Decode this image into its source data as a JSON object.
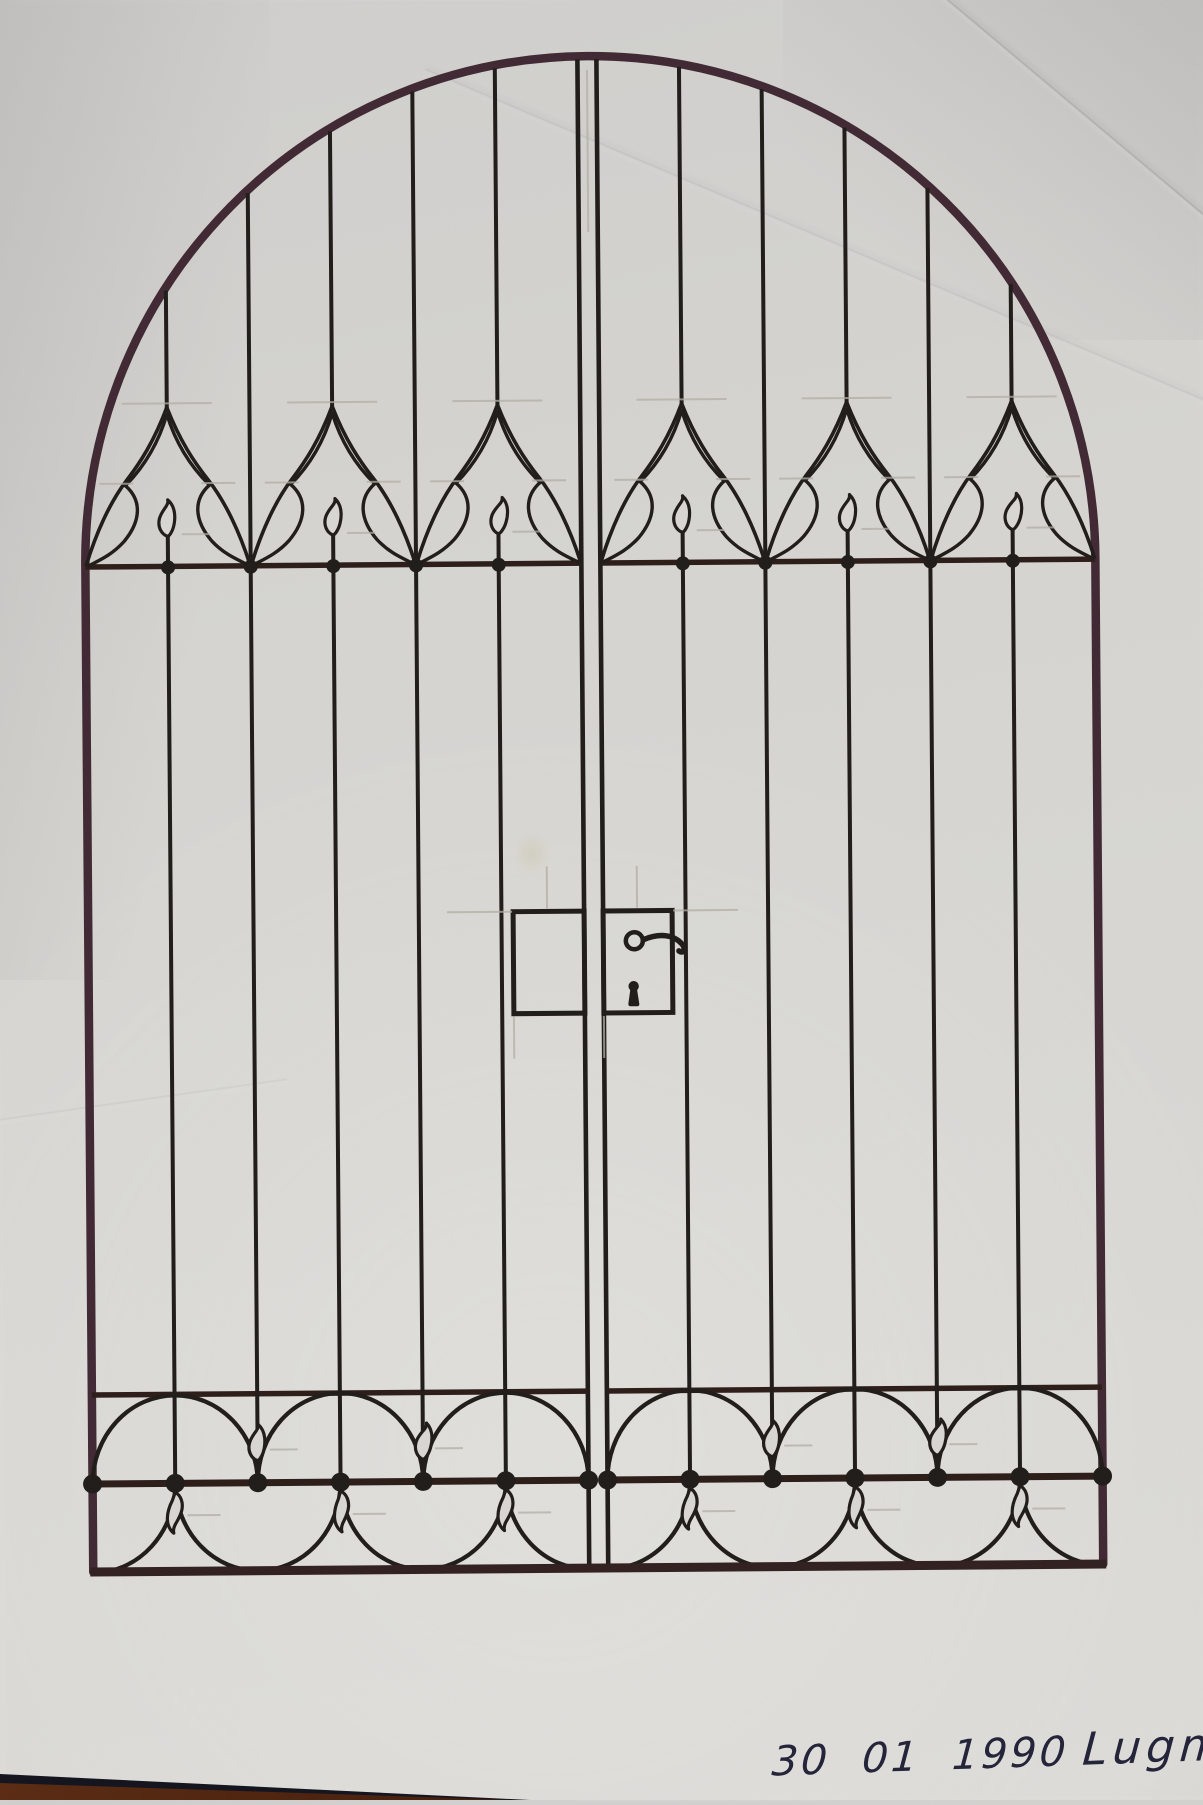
{
  "photo": {
    "description": "Photograph of a hand-drawn ink sketch on white paper: design for a double-leaf arched wrought-iron gate, lying on a dark wooden table visible at the bottom-left corner."
  },
  "annotation": {
    "date": "30 01 1990",
    "name": "Lugmayr"
  },
  "gate": {
    "leaves": 2,
    "bars_per_leaf": 5,
    "top_band": {
      "gothic_bell_motifs_per_leaf": 3,
      "flame_finials_per_leaf": 3
    },
    "bottom_band": {
      "upper_semicircles_per_leaf": 3,
      "lower_semicircles_per_leaf": 2,
      "corner_quarter_arcs_per_leaf": 2,
      "upward_flames_per_leaf": 2,
      "hanging_drop_pendants_per_leaf": 3
    },
    "lock": {
      "boxes": 2,
      "has_ring_handle": true,
      "has_keyhole": true
    }
  },
  "colors": {
    "paper": "#d8d7d3",
    "ink": "#1e1a17",
    "frame_ink": "#3f2732",
    "rail_ink": "#2b1b17",
    "bottom_rail_ink": "#301e1e",
    "pencil": "#b2aea5",
    "signature_ink": "#24243a",
    "table_wood": "#6b3418",
    "table_wood_dark": "#2e1408",
    "table_edge": "#15151f",
    "stain": "#b0a14e"
  }
}
